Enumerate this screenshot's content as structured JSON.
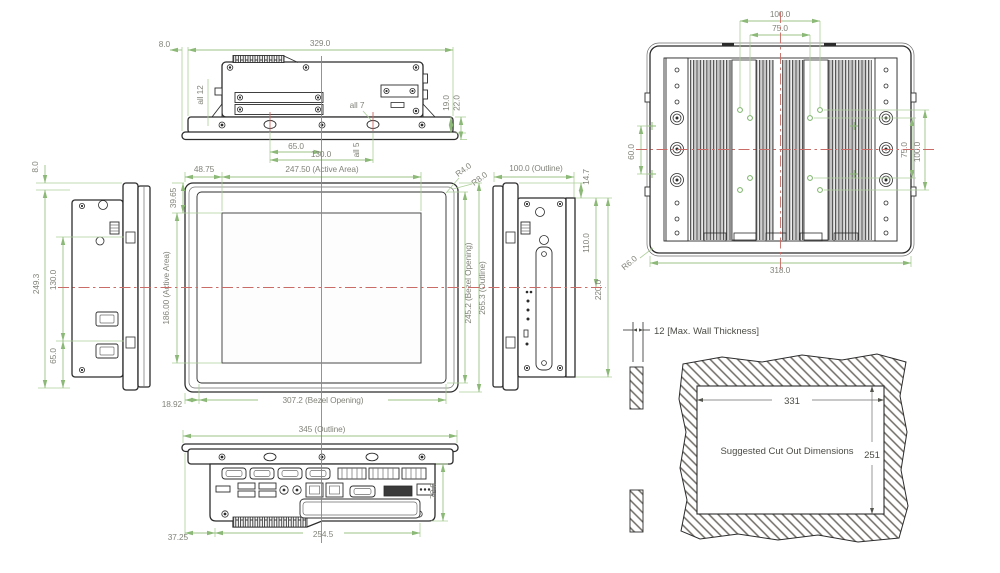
{
  "drawing": {
    "type": "engineering-dimension-drawing",
    "views": {
      "top": {
        "bezel_offset": "8.0",
        "body_width": "329.0",
        "note_all12": "all 12",
        "note_all7": "all 7",
        "plate_h": "19.0",
        "plate_total_h": "22.0",
        "hole_half_pitch": "65.0",
        "hole_pitch": "130.0",
        "note_all5": "all 5"
      },
      "left": {
        "bezel_offset": "8.0",
        "height": "249.3",
        "slot_pitch": "130.0",
        "slot_half": "65.0"
      },
      "front": {
        "margin_left": "48.75",
        "active_w": "247.50 (Active Area)",
        "r_bezel": "R4.0",
        "r_outline": "R8.0",
        "margin_top": "39.65",
        "active_h": "186.00 (Active Area)",
        "bezel_h": "245.2 (Bezel Opening)",
        "outline_h": "265.3 (Outline)",
        "margin_bottom": "18.92",
        "bezel_w": "307.2 (Bezel Opening)"
      },
      "right": {
        "depth": "100.0 (Outline)",
        "bezel_gap": "14.7",
        "upper_h": "110.0",
        "body_h": "220.0"
      },
      "rear": {
        "vesa100_top": "100.0",
        "vesa75_top": "75.0",
        "bracket_pitch": "60.0",
        "vesa75_side": "75.0",
        "vesa100_side": "100.0",
        "corner_r": "R6.0",
        "width": "318.0"
      },
      "bottom": {
        "outline_w": "345 (Outline)",
        "body_h": "72.0",
        "margin": "37.25",
        "body_w": "254.5"
      },
      "cutout": {
        "wall": "12 [Max. Wall Thickness]",
        "caption": "Suggested Cut Out Dimensions",
        "cut_w": "331",
        "cut_h": "251"
      }
    },
    "colors": {
      "dimension_line": "#accf99",
      "centerline": "#c96b66",
      "drawing_line": "#2c2c2c",
      "dim_text": "#83837b"
    }
  }
}
